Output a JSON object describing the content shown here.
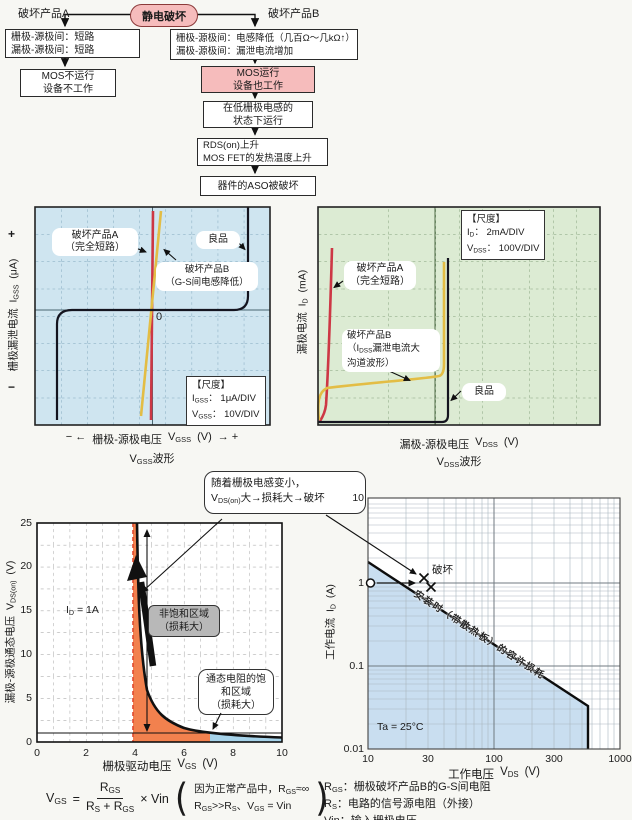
{
  "colors": {
    "pink": "#f6bcbc",
    "pink_border": "#8b3a3a",
    "scope_blue_bg": "#cfe5f0",
    "scope_green_bg": "#dcebd3",
    "red_line": "#cd3745",
    "yellow_line": "#e3bd45",
    "orange_region": "#f2814e",
    "lightblue_region": "#a6d3ea",
    "soa_region": "#c9def0",
    "grey_box": "#b8b8b8"
  },
  "flow": {
    "root": "静电破坏",
    "label_a": "破坏产品A",
    "label_b": "破坏产品B",
    "a1": [
      "栅极-源极间：短路",
      "漏极-源极间：短路"
    ],
    "a2": [
      "MOS不运行",
      "设备不工作"
    ],
    "b1": [
      "栅极-源极间：电感降低（几百Ω～几kΩ↑）",
      "漏极-源极间：漏泄电流增加"
    ],
    "b2": [
      "MOS运行",
      "设备也工作"
    ],
    "b3": [
      "在低栅极电感的",
      "状态下运行"
    ],
    "b4": [
      "RDS(on)上升",
      "MOS FET的发热温度上升"
    ],
    "b5": "器件的ASO被破坏"
  },
  "vgss": {
    "callout_a": {
      "l1": "破坏产品A",
      "l2": "（完全短路）"
    },
    "callout_b": {
      "l1": "破坏产品B",
      "l2": "（G-S间电感降低）"
    },
    "good": "良品",
    "zero": "0",
    "scale": {
      "title": "【尺度】",
      "l1": {
        "pre": "I",
        "sub": "GSS",
        "post": "： 1μA/DIV"
      },
      "l2": {
        "pre": "V",
        "sub": "GSS",
        "post": "： 10V/DIV"
      }
    },
    "ylabel": {
      "plus": "+",
      "text": "栅极漏泄电流",
      "sym": "I",
      "sub": "GSS",
      "unit": "(μA)",
      "minus": "−"
    },
    "xlabel": {
      "left": "− ←",
      "text": "栅极-源极电压",
      "sym": "V",
      "sub": "GSS",
      "unit": "(V)",
      "right": "→ +"
    },
    "title": {
      "sym": "V",
      "sub": "GSS",
      "post": "波形"
    }
  },
  "vdss": {
    "scale": {
      "title": "【尺度】",
      "l1": {
        "pre": "I",
        "sub": "D",
        "post": "： 2mA/DIV"
      },
      "l2": {
        "pre": "V",
        "sub": "DSS",
        "post": "： 100V/DIV"
      }
    },
    "callout_a": {
      "l1": "破坏产品A",
      "l2": "（完全短路）"
    },
    "callout_b": {
      "l1": "破坏产品B",
      "l2pre": "（I",
      "l2sub": "DSS",
      "l2post": "漏泄电流大",
      "l3": "沟道波形）"
    },
    "good": "良品",
    "ylabel": {
      "text": "漏极电流",
      "sym": "I",
      "sub": "D",
      "unit": "(mA)"
    },
    "xlabel": {
      "text": "漏极-源极电压",
      "sym": "V",
      "sub": "DSS",
      "unit": "(V)"
    },
    "title": {
      "sym": "V",
      "sub": "DSS",
      "post": "波形"
    }
  },
  "vdson": {
    "callout": {
      "l1": "随着栅极电感变小，",
      "l2pre": "V",
      "l2sub": "DS(on)",
      "l2post": "大→损耗大→破坏"
    },
    "id_label": {
      "pre": "I",
      "sub": "D",
      "post": " = 1A"
    },
    "region_unsat": {
      "l1": "非饱和区域",
      "l2": "（损耗大）"
    },
    "region_sat": {
      "l1": "通态电阻的饱",
      "l2": "和区域",
      "l3": "（损耗大）"
    },
    "yticks": [
      "25",
      "20",
      "15",
      "10",
      "5",
      "0"
    ],
    "xticks": [
      "0",
      "2",
      "4",
      "6",
      "8",
      "10"
    ],
    "ylabel": {
      "text": "漏极-源极通态电压",
      "sym": "V",
      "sub": "DS(on)",
      "unit": "(V)"
    },
    "xlabel": {
      "text": "栅极驱动电压",
      "sym": "V",
      "sub": "GS",
      "unit": "(V)"
    }
  },
  "soa": {
    "yticks": [
      "10",
      "1",
      "0.1",
      "0.01"
    ],
    "xticks": [
      "10",
      "30",
      "100",
      "300",
      "1000"
    ],
    "ylabel": {
      "text": "工作电流",
      "sym": "I",
      "sub": "D",
      "unit": "(A)"
    },
    "xlabel": {
      "text": "工作电压",
      "sym": "V",
      "sub": "DS",
      "unit": "(V)"
    },
    "diag_label": "安装时（带散热板）的容许损耗",
    "break_label": "破坏",
    "ta": "Ta = 25°C",
    "legend": {
      "l1": {
        "p1": "R",
        "s1": "GS",
        "p2": "：栅极破坏产品B的G-S间电阻"
      },
      "l2": {
        "p1": "R",
        "s1": "S",
        "p2": "：电路的信号源电阻（外接）"
      },
      "l3": {
        "p1": "Vin",
        "s1": "",
        "p2": "：输入栅极电压"
      }
    }
  },
  "formula": {
    "lhs": {
      "pre": "V",
      "sub": "GS"
    },
    "eq": "=",
    "num": {
      "pre": "R",
      "sub": "GS"
    },
    "den": {
      "p1": "R",
      "s1": "S",
      "plus": " + ",
      "p2": "R",
      "s2": "GS"
    },
    "times": "× Vin",
    "note1": {
      "pre": "因为正常产品中，R",
      "sub": "GS",
      "post": "≈∞"
    },
    "note2": {
      "p1": "R",
      "s1": "GS",
      "p2": ">>R",
      "s2": "S",
      "p3": "、V",
      "s3": "GS",
      "p4": " = Vin"
    }
  },
  "chart_data": [
    {
      "type": "line",
      "title": "V_GSS波形",
      "xlabel": "栅极-源极电压 V_GSS (V)",
      "ylabel": "栅极漏泄电流 I_GSS (μA)",
      "scale": {
        "I_GSS": "1μA/DIV",
        "V_GSS": "10V/DIV"
      },
      "grid": "on",
      "series": [
        {
          "name": "良品",
          "shape": "S形曲线：中段漏电流平坦，正负高压端垂直击穿"
        },
        {
          "name": "破坏产品A（完全短路）",
          "shape": "过0V的垂直直线"
        },
        {
          "name": "破坏产品B（G-S间电感降低）",
          "shape": "过0V的近垂直斜线"
        }
      ]
    },
    {
      "type": "line",
      "title": "V_DSS波形",
      "xlabel": "漏极-源极电压 V_DSS (V)",
      "ylabel": "漏极电流 I_D (mA)",
      "scale": {
        "I_D": "2mA/DIV",
        "V_DSS": "100V/DIV"
      },
      "grid": "on",
      "series": [
        {
          "name": "破坏产品A（完全短路）",
          "shape": "低压处近垂直直线"
        },
        {
          "name": "破坏产品B（I_DSS漏泄电流大，沟道波形）",
          "shape": "漏电流抬高的L形曲线，约400V处上折"
        },
        {
          "name": "良品",
          "shape": "沿零电流水平线，约450V处垂直上升"
        }
      ]
    },
    {
      "type": "line",
      "title": "V_GS vs V_DS(on)  (I_D = 1A)",
      "xlabel": "栅极驱动电压 V_GS (V)",
      "ylabel": "漏极-源极通态电压 V_DS(on) (V)",
      "xlim": [
        0,
        10
      ],
      "ylim": [
        0,
        25
      ],
      "x": [
        4.1,
        4.3,
        4.5,
        5,
        5.5,
        6,
        7,
        8,
        10
      ],
      "y": [
        25,
        15,
        8,
        4.3,
        3,
        2,
        1,
        0.8,
        0.6
      ],
      "regions": [
        {
          "label": "非饱和区域（损耗大）",
          "x": [
            3.9,
            7
          ],
          "color": "orange"
        },
        {
          "label": "通态电阻的饱和区域（损耗大）",
          "x": [
            7,
            10
          ],
          "color": "lightblue"
        }
      ]
    },
    {
      "type": "line",
      "title": "容许损耗 (SOA)",
      "xlabel": "工作电压 V_DS (V)",
      "ylabel": "工作电流 I_D (A)",
      "xscale": "log",
      "yscale": "log",
      "xlim": [
        10,
        1000
      ],
      "ylim": [
        0.01,
        10
      ],
      "boundary_x": [
        10,
        550,
        550
      ],
      "boundary_y": [
        1.7,
        0.032,
        0.01
      ],
      "boundary_label": "安装时（带散热板）的容许损耗",
      "marker": {
        "x": 10,
        "y": 1,
        "type": "open-circle"
      },
      "annotations": [
        {
          "label": "破坏",
          "x": 30,
          "y": 1
        },
        {
          "label": "Ta = 25°C"
        }
      ]
    }
  ]
}
